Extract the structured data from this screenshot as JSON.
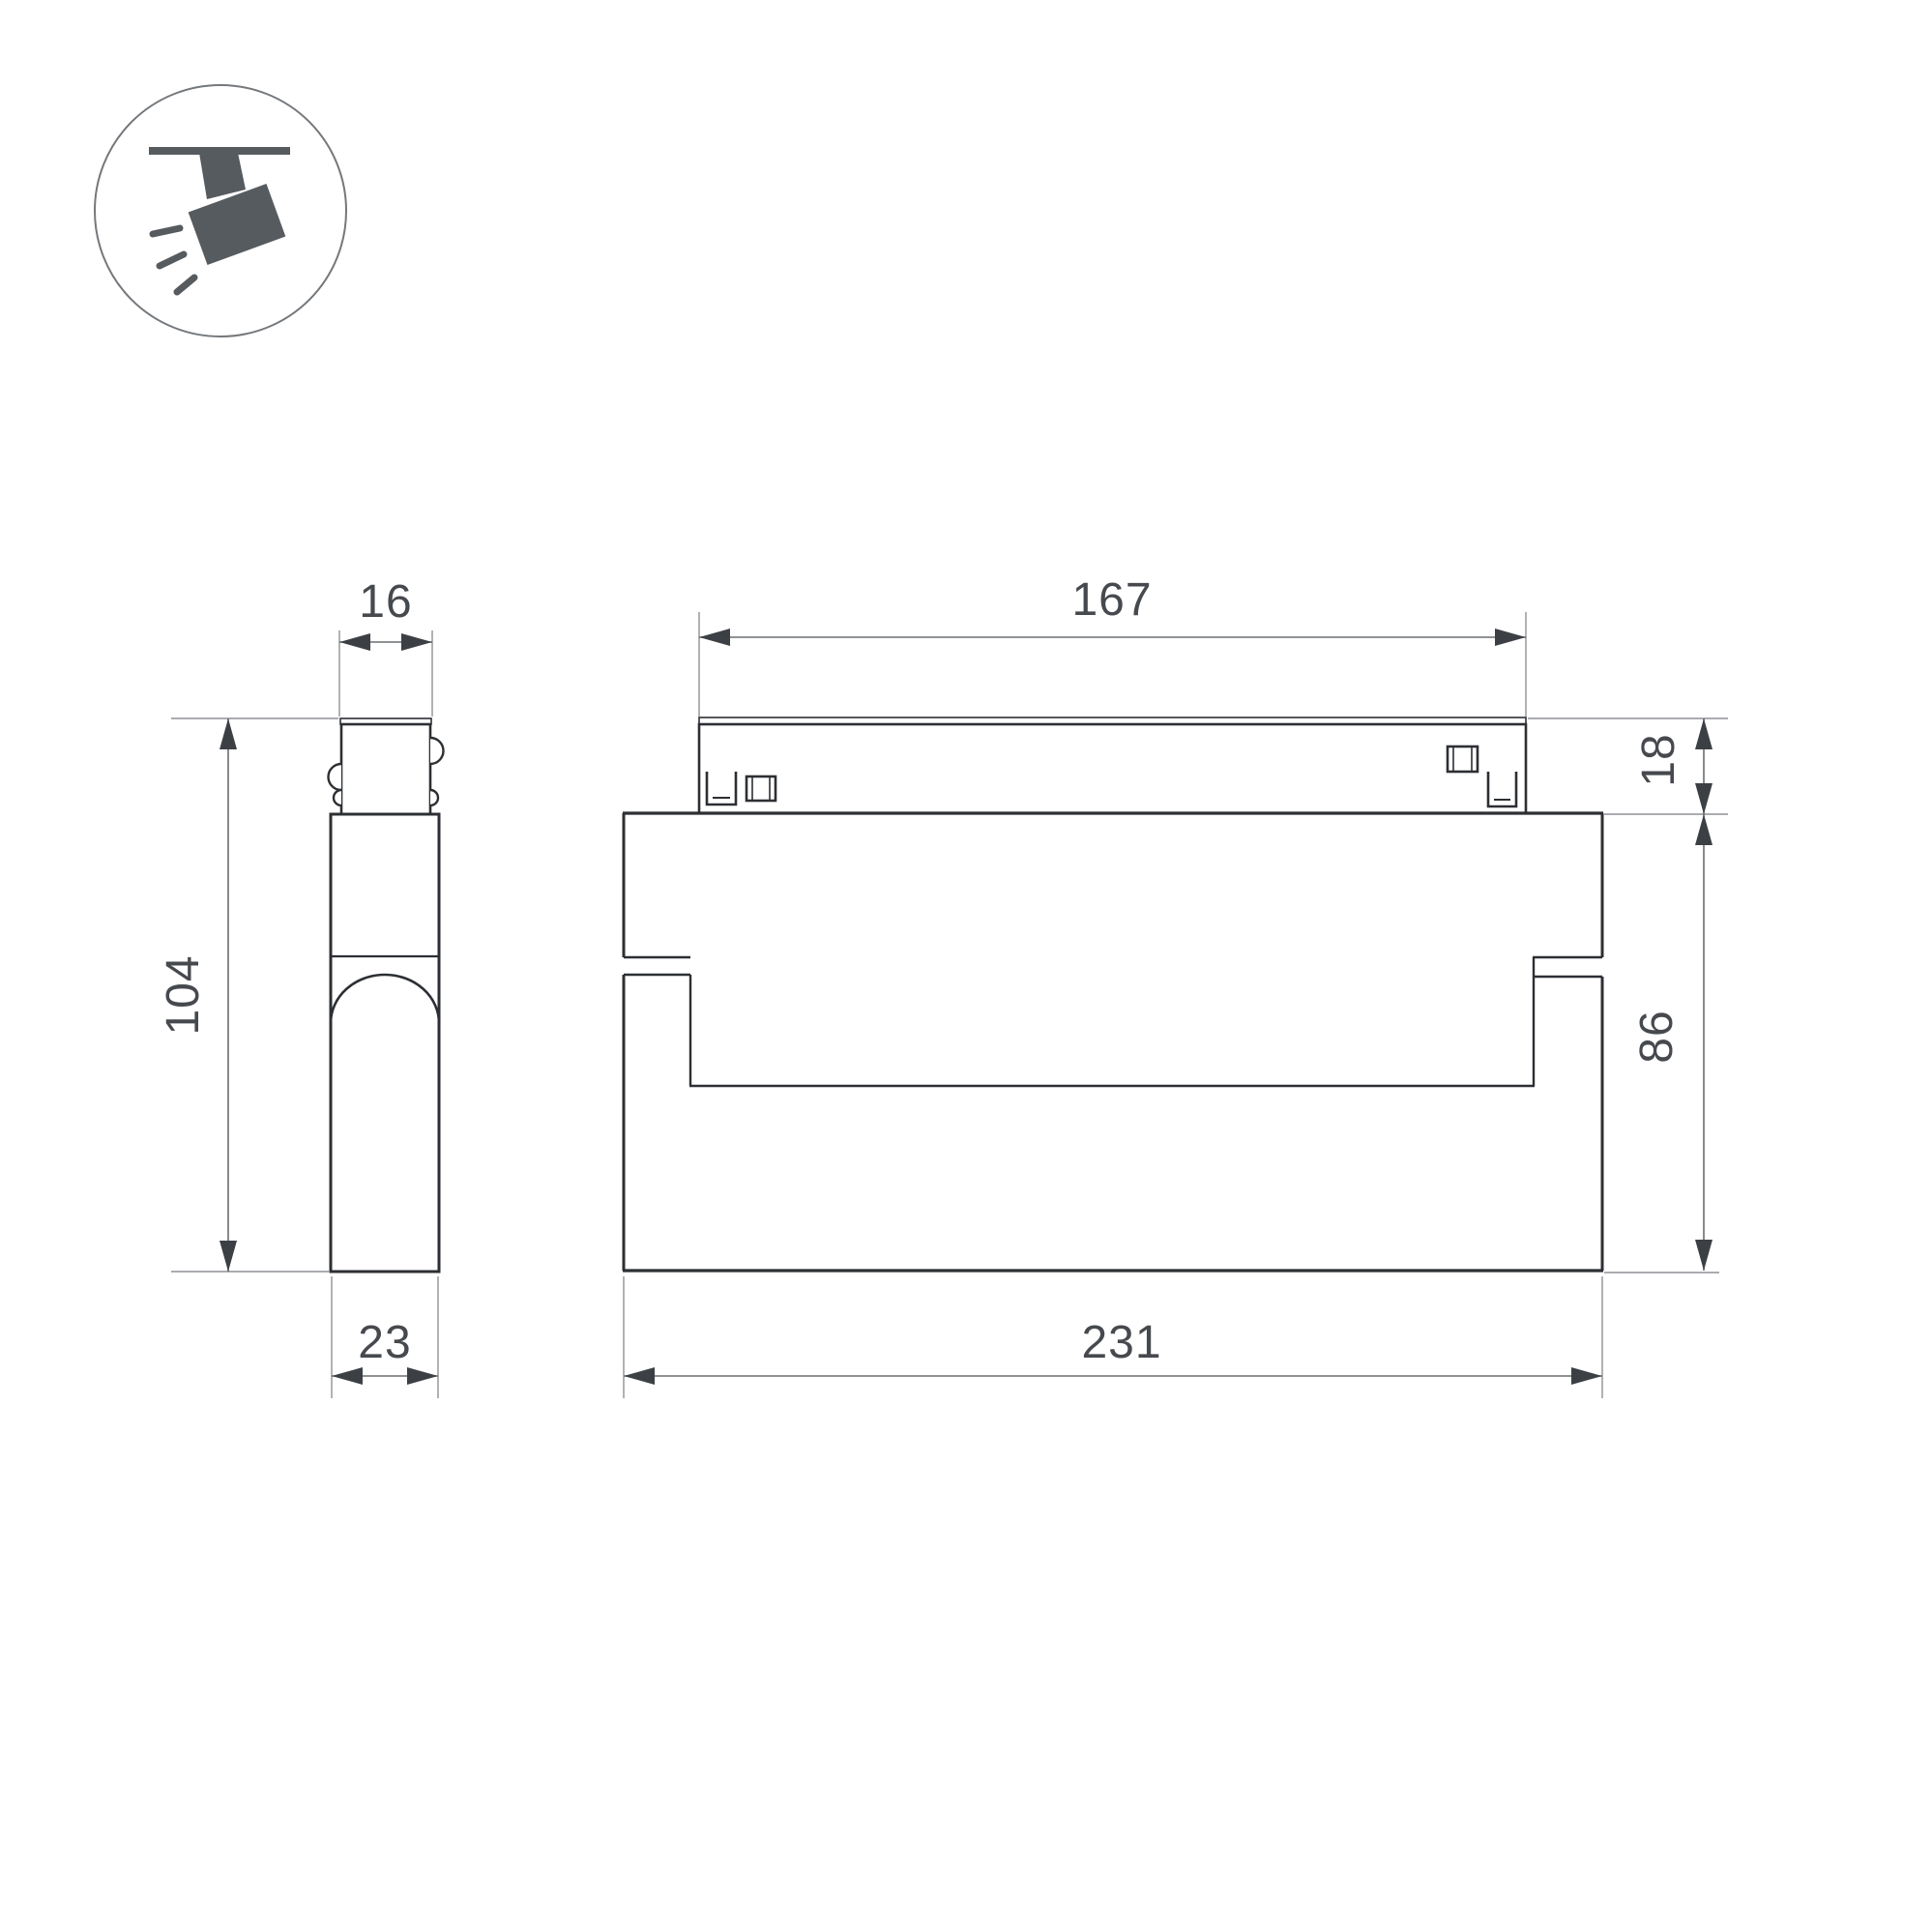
{
  "drawing": {
    "type": "technical-dimension-drawing",
    "subject": "magnetic-track-spotlight",
    "icon": "ceiling-track-spotlight-icon",
    "views": {
      "side_view": "left profile view of spotlight on track connector",
      "front_view": "front elevation view of spotlight body on track"
    },
    "dimensions": {
      "side_top_width": "16",
      "side_height": "104",
      "side_bottom_width": "23",
      "front_track_width": "167",
      "front_track_height": "18",
      "front_body_height": "86",
      "front_body_width": "231"
    },
    "colors": {
      "background": "#ffffff",
      "outline": "#2c2f33",
      "icon_fill": "#565b60",
      "dimension_line": "#6a6e72",
      "extension_line": "#8e9195",
      "arrow": "#3c4045",
      "text": "#46494d"
    }
  }
}
